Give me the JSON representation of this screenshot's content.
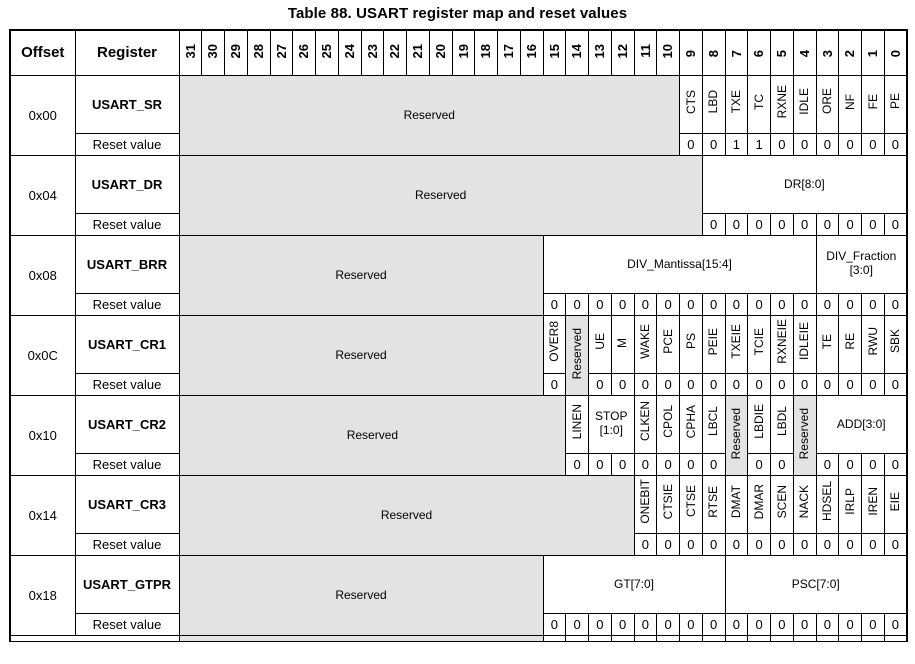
{
  "title": "Table 88. USART register map and reset values",
  "labels": {
    "offset": "Offset",
    "register": "Register",
    "reset_value": "Reset value",
    "reserved": "Reserved"
  },
  "colors": {
    "reserved_bg": "#e3e3e3",
    "border": "#000000",
    "text": "#000000",
    "page_bg": "#ffffff"
  },
  "header_bits": [
    "31",
    "30",
    "29",
    "28",
    "27",
    "26",
    "25",
    "24",
    "23",
    "22",
    "21",
    "20",
    "19",
    "18",
    "17",
    "16",
    "15",
    "14",
    "13",
    "12",
    "11",
    "10",
    "9",
    "8",
    "7",
    "6",
    "5",
    "4",
    "3",
    "2",
    "1",
    "0"
  ],
  "rows": [
    {
      "offset": "0x00",
      "register": "USART_SR",
      "fields": [
        {
          "label": "Reserved",
          "span": 22,
          "dir": "h",
          "reserved": true
        },
        {
          "label": "CTS",
          "span": 1,
          "dir": "v",
          "reset": [
            "0"
          ]
        },
        {
          "label": "LBD",
          "span": 1,
          "dir": "v",
          "reset": [
            "0"
          ]
        },
        {
          "label": "TXE",
          "span": 1,
          "dir": "v",
          "reset": [
            "1"
          ]
        },
        {
          "label": "TC",
          "span": 1,
          "dir": "v",
          "reset": [
            "1"
          ]
        },
        {
          "label": "RXNE",
          "span": 1,
          "dir": "v",
          "reset": [
            "0"
          ]
        },
        {
          "label": "IDLE",
          "span": 1,
          "dir": "v",
          "reset": [
            "0"
          ]
        },
        {
          "label": "ORE",
          "span": 1,
          "dir": "v",
          "reset": [
            "0"
          ]
        },
        {
          "label": "NF",
          "span": 1,
          "dir": "v",
          "reset": [
            "0"
          ]
        },
        {
          "label": "FE",
          "span": 1,
          "dir": "v",
          "reset": [
            "0"
          ]
        },
        {
          "label": "PE",
          "span": 1,
          "dir": "v",
          "reset": [
            "0"
          ]
        }
      ]
    },
    {
      "offset": "0x04",
      "register": "USART_DR",
      "fields": [
        {
          "label": "Reserved",
          "span": 23,
          "dir": "h",
          "reserved": true
        },
        {
          "label": "DR[8:0]",
          "span": 9,
          "dir": "h",
          "reset": [
            "0",
            "0",
            "0",
            "0",
            "0",
            "0",
            "0",
            "0",
            "0"
          ]
        }
      ]
    },
    {
      "offset": "0x08",
      "register": "USART_BRR",
      "fields": [
        {
          "label": "Reserved",
          "span": 16,
          "dir": "h",
          "reserved": true
        },
        {
          "label": "DIV_Mantissa[15:4]",
          "span": 12,
          "dir": "h",
          "reset": [
            "0",
            "0",
            "0",
            "0",
            "0",
            "0",
            "0",
            "0",
            "0",
            "0",
            "0",
            "0"
          ]
        },
        {
          "label": "DIV_Fraction [3:0]",
          "span": 4,
          "dir": "h",
          "reset": [
            "0",
            "0",
            "0",
            "0"
          ]
        }
      ]
    },
    {
      "offset": "0x0C",
      "register": "USART_CR1",
      "fields": [
        {
          "label": "Reserved",
          "span": 16,
          "dir": "h",
          "reserved": true
        },
        {
          "label": "OVER8",
          "span": 1,
          "dir": "v",
          "reset": [
            "0"
          ]
        },
        {
          "label": "Reserved",
          "span": 1,
          "dir": "v",
          "reserved": true
        },
        {
          "label": "UE",
          "span": 1,
          "dir": "v",
          "reset": [
            "0"
          ]
        },
        {
          "label": "M",
          "span": 1,
          "dir": "v",
          "reset": [
            "0"
          ]
        },
        {
          "label": "WAKE",
          "span": 1,
          "dir": "v",
          "reset": [
            "0"
          ]
        },
        {
          "label": "PCE",
          "span": 1,
          "dir": "v",
          "reset": [
            "0"
          ]
        },
        {
          "label": "PS",
          "span": 1,
          "dir": "v",
          "reset": [
            "0"
          ]
        },
        {
          "label": "PEIE",
          "span": 1,
          "dir": "v",
          "reset": [
            "0"
          ]
        },
        {
          "label": "TXEIE",
          "span": 1,
          "dir": "v",
          "reset": [
            "0"
          ]
        },
        {
          "label": "TCIE",
          "span": 1,
          "dir": "v",
          "reset": [
            "0"
          ]
        },
        {
          "label": "RXNEIE",
          "span": 1,
          "dir": "v",
          "reset": [
            "0"
          ]
        },
        {
          "label": "IDLEIE",
          "span": 1,
          "dir": "v",
          "reset": [
            "0"
          ]
        },
        {
          "label": "TE",
          "span": 1,
          "dir": "v",
          "reset": [
            "0"
          ]
        },
        {
          "label": "RE",
          "span": 1,
          "dir": "v",
          "reset": [
            "0"
          ]
        },
        {
          "label": "RWU",
          "span": 1,
          "dir": "v",
          "reset": [
            "0"
          ]
        },
        {
          "label": "SBK",
          "span": 1,
          "dir": "v",
          "reset": [
            "0"
          ]
        }
      ]
    },
    {
      "offset": "0x10",
      "register": "USART_CR2",
      "fields": [
        {
          "label": "Reserved",
          "span": 17,
          "dir": "h",
          "reserved": true
        },
        {
          "label": "LINEN",
          "span": 1,
          "dir": "v",
          "reset": [
            "0"
          ]
        },
        {
          "label": "STOP [1:0]",
          "span": 2,
          "dir": "h",
          "reset": [
            "0",
            "0"
          ]
        },
        {
          "label": "CLKEN",
          "span": 1,
          "dir": "v",
          "reset": [
            "0"
          ]
        },
        {
          "label": "CPOL",
          "span": 1,
          "dir": "v",
          "reset": [
            "0"
          ]
        },
        {
          "label": "CPHA",
          "span": 1,
          "dir": "v",
          "reset": [
            "0"
          ]
        },
        {
          "label": "LBCL",
          "span": 1,
          "dir": "v",
          "reset": [
            "0"
          ]
        },
        {
          "label": "Reserved",
          "span": 1,
          "dir": "v",
          "reserved": true
        },
        {
          "label": "LBDIE",
          "span": 1,
          "dir": "v",
          "reset": [
            "0"
          ]
        },
        {
          "label": "LBDL",
          "span": 1,
          "dir": "v",
          "reset": [
            "0"
          ]
        },
        {
          "label": "Reserved",
          "span": 1,
          "dir": "v",
          "reserved": true
        },
        {
          "label": "ADD[3:0]",
          "span": 4,
          "dir": "h",
          "reset": [
            "0",
            "0",
            "0",
            "0"
          ]
        }
      ]
    },
    {
      "offset": "0x14",
      "register": "USART_CR3",
      "fields": [
        {
          "label": "Reserved",
          "span": 20,
          "dir": "h",
          "reserved": true
        },
        {
          "label": "ONEBIT",
          "span": 1,
          "dir": "v",
          "reset": [
            "0"
          ]
        },
        {
          "label": "CTSIE",
          "span": 1,
          "dir": "v",
          "reset": [
            "0"
          ]
        },
        {
          "label": "CTSE",
          "span": 1,
          "dir": "v",
          "reset": [
            "0"
          ]
        },
        {
          "label": "RTSE",
          "span": 1,
          "dir": "v",
          "reset": [
            "0"
          ]
        },
        {
          "label": "DMAT",
          "span": 1,
          "dir": "v",
          "reset": [
            "0"
          ]
        },
        {
          "label": "DMAR",
          "span": 1,
          "dir": "v",
          "reset": [
            "0"
          ]
        },
        {
          "label": "SCEN",
          "span": 1,
          "dir": "v",
          "reset": [
            "0"
          ]
        },
        {
          "label": "NACK",
          "span": 1,
          "dir": "v",
          "reset": [
            "0"
          ]
        },
        {
          "label": "HDSEL",
          "span": 1,
          "dir": "v",
          "reset": [
            "0"
          ]
        },
        {
          "label": "IRLP",
          "span": 1,
          "dir": "v",
          "reset": [
            "0"
          ]
        },
        {
          "label": "IREN",
          "span": 1,
          "dir": "v",
          "reset": [
            "0"
          ]
        },
        {
          "label": "EIE",
          "span": 1,
          "dir": "v",
          "reset": [
            "0"
          ]
        }
      ]
    },
    {
      "offset": "0x18",
      "register": "USART_GTPR",
      "fields": [
        {
          "label": "Reserved",
          "span": 16,
          "dir": "h",
          "reserved": true
        },
        {
          "label": "GT[7:0]",
          "span": 8,
          "dir": "h",
          "reset": [
            "0",
            "0",
            "0",
            "0",
            "0",
            "0",
            "0",
            "0"
          ]
        },
        {
          "label": "PSC[7:0]",
          "span": 8,
          "dir": "h",
          "reset": [
            "0",
            "0",
            "0",
            "0",
            "0",
            "0",
            "0",
            "0"
          ]
        }
      ]
    }
  ]
}
